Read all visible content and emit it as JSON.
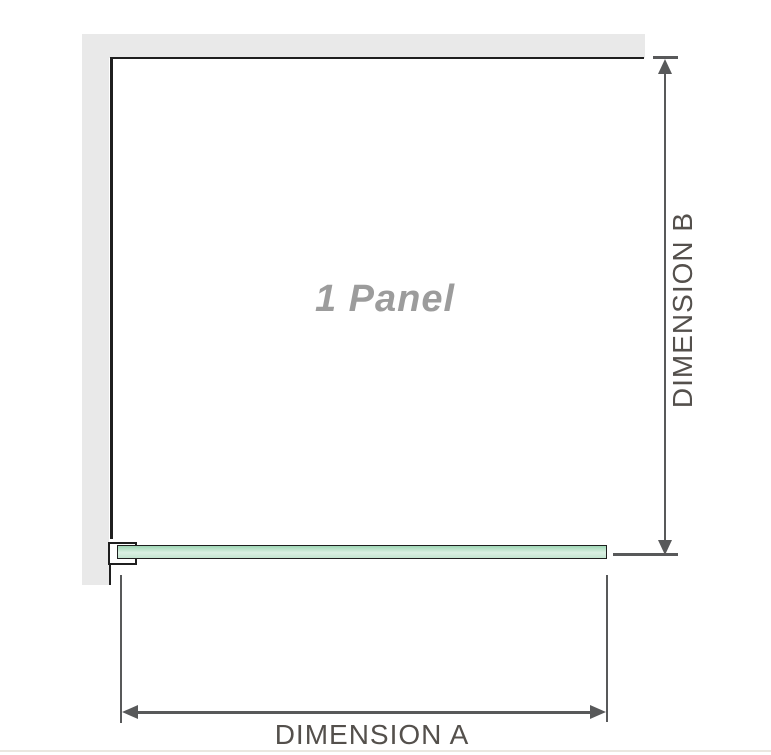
{
  "diagram": {
    "panel_label": "1 Panel",
    "dimension_a_label": "DIMENSION A",
    "dimension_b_label": "DIMENSION B"
  },
  "colors": {
    "wall": "#e9e9e9",
    "outline": "#1f1f1f",
    "dim-line": "#58595a",
    "dim-text": "#54504c",
    "panel-label": "#9c9c9c",
    "glass-top": "#9ed6b5",
    "glass-mid": "#dbf0e3",
    "glass-bottom": "#c4e5d0",
    "baseline": "#eae7e0"
  }
}
